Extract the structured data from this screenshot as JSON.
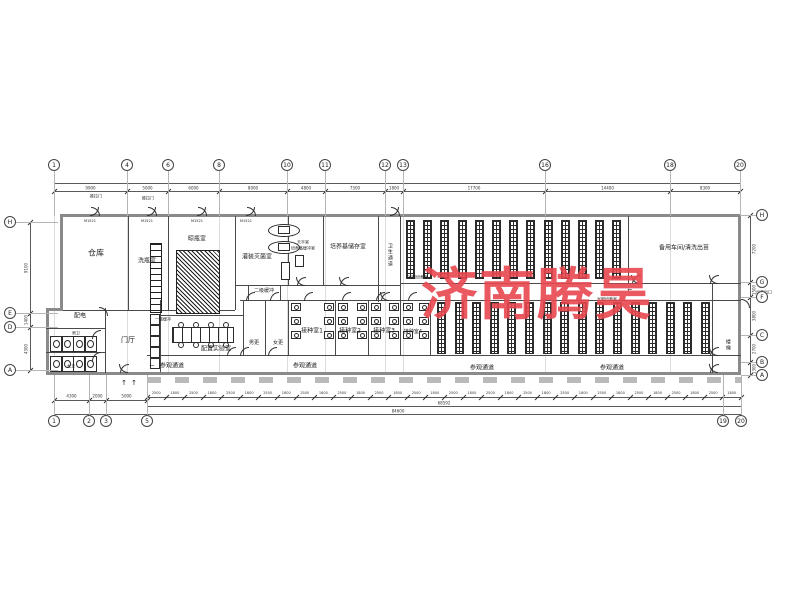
{
  "watermark": {
    "text": "济南腾昊",
    "color": "#E8474F",
    "x": 421,
    "y": 250,
    "size": 56
  },
  "room_labels": [
    {
      "name": "room-warehouse",
      "text": "仓库",
      "x": 96,
      "y": 253,
      "fs": 8
    },
    {
      "name": "room-bottle-washing",
      "text": "洗瓶室",
      "x": 147,
      "y": 262,
      "fs": 6
    },
    {
      "name": "room-bottle-drying",
      "text": "晾瓶室",
      "x": 197,
      "y": 240,
      "fs": 6
    },
    {
      "name": "room-filling-sterilizing",
      "text": "灌装灭菌室",
      "x": 257,
      "y": 258,
      "fs": 6
    },
    {
      "name": "room-balance",
      "text": "天平室",
      "x": 303,
      "y": 243,
      "fs": 4
    },
    {
      "name": "room-medium-buffer",
      "text": "培养基缓冲室",
      "x": 303,
      "y": 249,
      "fs": 4
    },
    {
      "name": "room-medium-storage",
      "text": "培养基储存室",
      "x": 348,
      "y": 248,
      "fs": 6
    },
    {
      "name": "corridor-sanitary",
      "text": "卫生通道",
      "x": 389,
      "y": 255,
      "fs": 5,
      "vert": true
    },
    {
      "name": "room-light-culture-1",
      "text": "光照培养室",
      "x": 418,
      "y": 278,
      "fs": 4
    },
    {
      "name": "room-spare-workshop",
      "text": "备用车间/清洗出苗",
      "x": 684,
      "y": 249,
      "fs": 6
    },
    {
      "name": "room-buffer-2",
      "text": "二级缓冲",
      "x": 264,
      "y": 292,
      "fs": 5
    },
    {
      "name": "room-buffer-1",
      "text": "一级缓冲",
      "x": 163,
      "y": 320,
      "fs": 4
    },
    {
      "name": "room-men-change",
      "text": "男更",
      "x": 254,
      "y": 344,
      "fs": 5
    },
    {
      "name": "room-women-change",
      "text": "女更",
      "x": 278,
      "y": 344,
      "fs": 5
    },
    {
      "name": "room-inoculation-1",
      "text": "接种室1",
      "x": 312,
      "y": 332,
      "fs": 6
    },
    {
      "name": "room-inoculation-2",
      "text": "接种室2",
      "x": 350,
      "y": 332,
      "fs": 6
    },
    {
      "name": "room-inoculation-3",
      "text": "接种室3",
      "x": 384,
      "y": 332,
      "fs": 6
    },
    {
      "name": "room-inoculation-4",
      "text": "接种室4",
      "x": 413,
      "y": 333,
      "fs": 5
    },
    {
      "name": "room-light-culture-2",
      "text": "光照培养室",
      "x": 607,
      "y": 300,
      "fs": 4
    },
    {
      "name": "room-prep-lab",
      "text": "配置实验室",
      "x": 216,
      "y": 350,
      "fs": 6
    },
    {
      "name": "room-power",
      "text": "配电",
      "x": 80,
      "y": 317,
      "fs": 6
    },
    {
      "name": "room-men-wc",
      "text": "男卫",
      "x": 76,
      "y": 334,
      "fs": 4
    },
    {
      "name": "room-women-wc",
      "text": "女卫",
      "x": 71,
      "y": 367,
      "fs": 4
    },
    {
      "name": "room-lobby",
      "text": "门厅",
      "x": 128,
      "y": 340,
      "fs": 7
    },
    {
      "name": "room-stair",
      "text": "楼梯",
      "x": 727,
      "y": 345,
      "fs": 5,
      "vert": true
    },
    {
      "name": "corridor-visit-1",
      "text": "参观通道",
      "x": 172,
      "y": 367,
      "fs": 6
    },
    {
      "name": "corridor-visit-2",
      "text": "参观通道",
      "x": 305,
      "y": 367,
      "fs": 6
    },
    {
      "name": "corridor-visit-3",
      "text": "参观通道",
      "x": 482,
      "y": 369,
      "fs": 6
    },
    {
      "name": "corridor-visit-4",
      "text": "参观通道",
      "x": 612,
      "y": 369,
      "fs": 6
    },
    {
      "name": "tag-sliding-door-1",
      "text": "推拉门",
      "x": 96,
      "y": 197,
      "fs": 4
    },
    {
      "name": "tag-sliding-door-2",
      "text": "推拉门",
      "x": 148,
      "y": 199,
      "fs": 4
    },
    {
      "name": "tag-seedling-exit",
      "text": "出苗出口",
      "x": 764,
      "y": 293,
      "fs": 4
    },
    {
      "name": "door-tag-1",
      "text": "M1521",
      "x": 90,
      "y": 221,
      "fs": 3.5
    },
    {
      "name": "door-tag-2",
      "text": "M1521",
      "x": 147,
      "y": 221,
      "fs": 3.5
    },
    {
      "name": "door-tag-3",
      "text": "M1521",
      "x": 197,
      "y": 221,
      "fs": 3.5
    },
    {
      "name": "door-tag-4",
      "text": "M1521",
      "x": 246,
      "y": 221,
      "fs": 3.5
    },
    {
      "name": "arrow-corridor-left",
      "text": "←",
      "x": 152,
      "y": 367,
      "fs": 6
    },
    {
      "name": "arrow-corridor-mid",
      "text": "←",
      "x": 630,
      "y": 291,
      "fs": 6
    },
    {
      "name": "arrow-entry-1",
      "text": "↑",
      "x": 124,
      "y": 383,
      "fs": 7
    },
    {
      "name": "arrow-entry-2",
      "text": "↑",
      "x": 134,
      "y": 383,
      "fs": 7
    }
  ],
  "grid": {
    "top": [
      {
        "x": 54,
        "n": "1"
      },
      {
        "x": 127,
        "n": "4"
      },
      {
        "x": 168,
        "n": "6"
      },
      {
        "x": 219,
        "n": "8"
      },
      {
        "x": 287,
        "n": "10"
      },
      {
        "x": 325,
        "n": "11"
      },
      {
        "x": 385,
        "n": "12"
      },
      {
        "x": 403,
        "n": "13"
      },
      {
        "x": 545,
        "n": "16"
      },
      {
        "x": 670,
        "n": "18"
      },
      {
        "x": 740,
        "n": "20"
      }
    ],
    "bottom_left": [
      {
        "x": 54,
        "n": "1"
      },
      {
        "x": 89,
        "n": "2"
      },
      {
        "x": 106,
        "n": "3"
      },
      {
        "x": 147,
        "n": "5"
      }
    ],
    "bottom_right": [
      {
        "x": 723,
        "n": "19"
      },
      {
        "x": 741,
        "n": "20"
      }
    ],
    "left": [
      {
        "y": 222,
        "n": "H"
      },
      {
        "y": 313,
        "n": "E"
      },
      {
        "y": 327,
        "n": "D"
      },
      {
        "y": 370,
        "n": "A"
      }
    ],
    "right": [
      {
        "y": 215,
        "n": "H"
      },
      {
        "y": 282,
        "n": "G"
      },
      {
        "y": 297,
        "n": "F"
      },
      {
        "y": 335,
        "n": "C"
      },
      {
        "y": 362,
        "n": "B"
      },
      {
        "y": 375,
        "n": "A"
      }
    ]
  },
  "dims": {
    "top_points": [
      54,
      127,
      168,
      219,
      287,
      325,
      385,
      403,
      545,
      670,
      740
    ],
    "top_values": [
      "9900",
      "5000",
      "6000",
      "8000",
      "4800",
      "7500",
      "1800",
      "17700",
      "14400",
      "8300"
    ],
    "bottom_left_points": [
      54,
      89,
      106,
      147
    ],
    "bottom_left_values": [
      "4300",
      "2000",
      "5000"
    ],
    "chain": {
      "x1": 147,
      "x2": 741,
      "y": 397,
      "n": 32,
      "alt": [
        "2500",
        "1800"
      ]
    },
    "subtotal": {
      "text": "68592",
      "x": 444,
      "y": 403
    },
    "total": {
      "text": "84600",
      "x": 398,
      "y": 411
    },
    "right_values": [
      "7200",
      "1500",
      "3800",
      "2700",
      "1300"
    ],
    "left_values": [
      "9100",
      "1400",
      "4300"
    ]
  },
  "geometry": {
    "walls": [
      [
        60,
        214,
        681,
        3
      ],
      [
        738,
        214,
        3,
        161
      ],
      [
        46,
        372,
        695,
        3
      ],
      [
        60,
        214,
        3,
        97
      ],
      [
        46,
        308,
        3,
        67
      ],
      [
        46,
        308,
        17,
        3
      ]
    ],
    "thin": [
      [
        128,
        216,
        1,
        94
      ],
      [
        168,
        216,
        1,
        94
      ],
      [
        235,
        216,
        1,
        94
      ],
      [
        288,
        216,
        1,
        69
      ],
      [
        323,
        216,
        1,
        69
      ],
      [
        378,
        216,
        1,
        86
      ],
      [
        400,
        216,
        1,
        86
      ],
      [
        628,
        216,
        1,
        67
      ],
      [
        712,
        283,
        1,
        90
      ],
      [
        160,
        300,
        1,
        72
      ],
      [
        243,
        300,
        1,
        55
      ],
      [
        265,
        300,
        1,
        55
      ],
      [
        288,
        300,
        1,
        55
      ],
      [
        335,
        300,
        1,
        55
      ],
      [
        368,
        300,
        1,
        55
      ],
      [
        400,
        300,
        1,
        55
      ],
      [
        430,
        300,
        1,
        55
      ],
      [
        105,
        308,
        1,
        65
      ],
      [
        63,
        310,
        172,
        1
      ],
      [
        235,
        285,
        165,
        1
      ],
      [
        400,
        283,
        341,
        1
      ],
      [
        240,
        300,
        501,
        1
      ],
      [
        147,
        355,
        594,
        1
      ],
      [
        46,
        328,
        59,
        1
      ],
      [
        46,
        352,
        59,
        1
      ],
      [
        160,
        315,
        83,
        1
      ],
      [
        248,
        285,
        1,
        15
      ],
      [
        280,
        285,
        1,
        15
      ]
    ],
    "racks_top": {
      "x0": 406,
      "step": 17.2,
      "n": 13,
      "y": 220,
      "h": 57,
      "w": 7
    },
    "racks_bottom": {
      "x0": 437,
      "step": 17.6,
      "n": 16,
      "y": 302,
      "h": 50,
      "w": 7
    },
    "hatch_block": [
      176,
      250,
      42,
      62
    ],
    "ladder": [
      150,
      243,
      10,
      68
    ],
    "ovals": [
      [
        268,
        224,
        30,
        11
      ],
      [
        268,
        241,
        30,
        11
      ]
    ],
    "equip_rects": [
      [
        281,
        262,
        7,
        16
      ],
      [
        295,
        255,
        7,
        10
      ]
    ],
    "lab_bench": [
      172,
      327,
      60,
      14
    ],
    "lockers": {
      "x": 150,
      "y0": 314,
      "n": 5,
      "step": 11,
      "w": 8,
      "h": 9
    },
    "stalls_men": {
      "x0": 50,
      "y": 336,
      "n": 4,
      "step": 11.5,
      "w": 10,
      "h": 14
    },
    "stalls_women": {
      "x0": 50,
      "y": 356,
      "n": 4,
      "step": 11.5,
      "w": 10,
      "h": 14
    },
    "bench_rooms": [
      [
        288,
        335
      ],
      [
        335,
        368
      ],
      [
        368,
        400
      ],
      [
        400,
        430
      ]
    ],
    "bench_ys": [
      303,
      317,
      331
    ],
    "doors_double": [
      [
        90,
        215,
        "up"
      ],
      [
        147,
        215,
        "up"
      ],
      [
        197,
        215,
        "up"
      ],
      [
        246,
        215,
        "up"
      ],
      [
        390,
        215,
        "up"
      ],
      [
        305,
        285,
        "down"
      ],
      [
        348,
        285,
        "down"
      ],
      [
        389,
        300,
        "down"
      ],
      [
        640,
        283,
        "down"
      ],
      [
        718,
        283,
        "down"
      ],
      [
        718,
        355,
        "down"
      ],
      [
        718,
        372,
        "down"
      ],
      [
        128,
        372,
        "down"
      ]
    ],
    "doors_single": [
      [
        254,
        300,
        "down"
      ],
      [
        278,
        300,
        "down"
      ],
      [
        312,
        300,
        "down"
      ],
      [
        350,
        300,
        "down"
      ],
      [
        384,
        300,
        "down"
      ],
      [
        416,
        300,
        "down"
      ],
      [
        248,
        355,
        "down"
      ],
      [
        276,
        355,
        "down"
      ],
      [
        235,
        355,
        "down"
      ],
      [
        100,
        338,
        "left"
      ],
      [
        100,
        360,
        "left"
      ],
      [
        98,
        315,
        "right"
      ],
      [
        740,
        307,
        "right"
      ]
    ],
    "walk": [
      147,
      377,
      594
    ]
  }
}
